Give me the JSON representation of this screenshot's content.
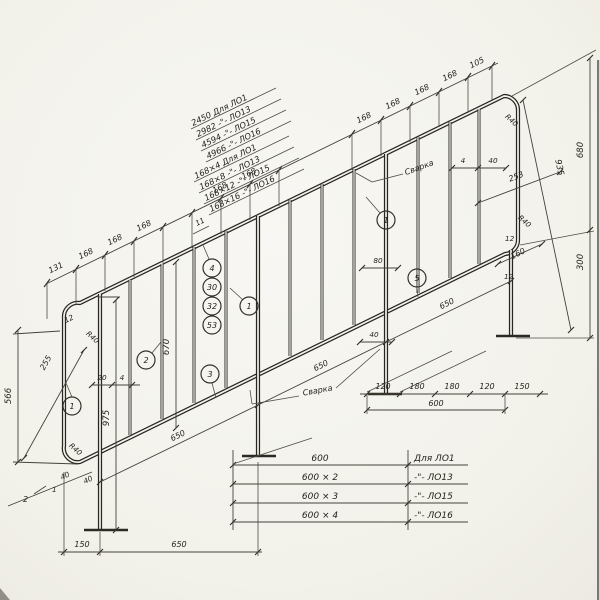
{
  "labels": {
    "chain_top": [
      "131",
      "168",
      "168",
      "168",
      "168",
      "168",
      "168",
      "168",
      "168",
      "168",
      "105"
    ],
    "chain_bottom": [
      "120",
      "180",
      "180",
      "120",
      "150"
    ],
    "span600": "600",
    "left150": "150",
    "left650": "650",
    "span650": "650",
    "d11": "11",
    "d12": "12",
    "d20": "20",
    "d4": "4",
    "d40": "40",
    "d80": "80",
    "d160": "160",
    "d253": "253",
    "d255": "255",
    "d300": "300",
    "d566": "566",
    "d670": "670",
    "d680": "680",
    "d935": "935",
    "d975": "975",
    "r40": "R40",
    "weld": "Сварка",
    "sec1": "1",
    "sec2": "2"
  },
  "callouts": {
    "c1": "1",
    "c2": "2",
    "c3": "3",
    "c4": "4",
    "c30": "30",
    "c32": "32",
    "c53": "53",
    "c1m": "1",
    "c1t": "1",
    "c5": "5"
  },
  "tables": {
    "lengths": [
      "2450   Для ЛО1",
      "2982   -\"-  ЛО13",
      "4594   -\"-  ЛО15",
      "4966   -\"-  ЛО16"
    ],
    "bars": [
      "168×4    Для ЛО1",
      "168×8    -\"-  ЛО13",
      "168×12  -\"-  ЛО15",
      "168×16  -\"-  ЛО16"
    ],
    "modules": {
      "values": [
        "600",
        "600 × 2",
        "600 × 3",
        "600 × 4"
      ],
      "refs": [
        "Для ЛО1",
        "-\"-  ЛО13",
        "-\"-  ЛО15",
        "-\"-  ЛО16"
      ]
    }
  }
}
